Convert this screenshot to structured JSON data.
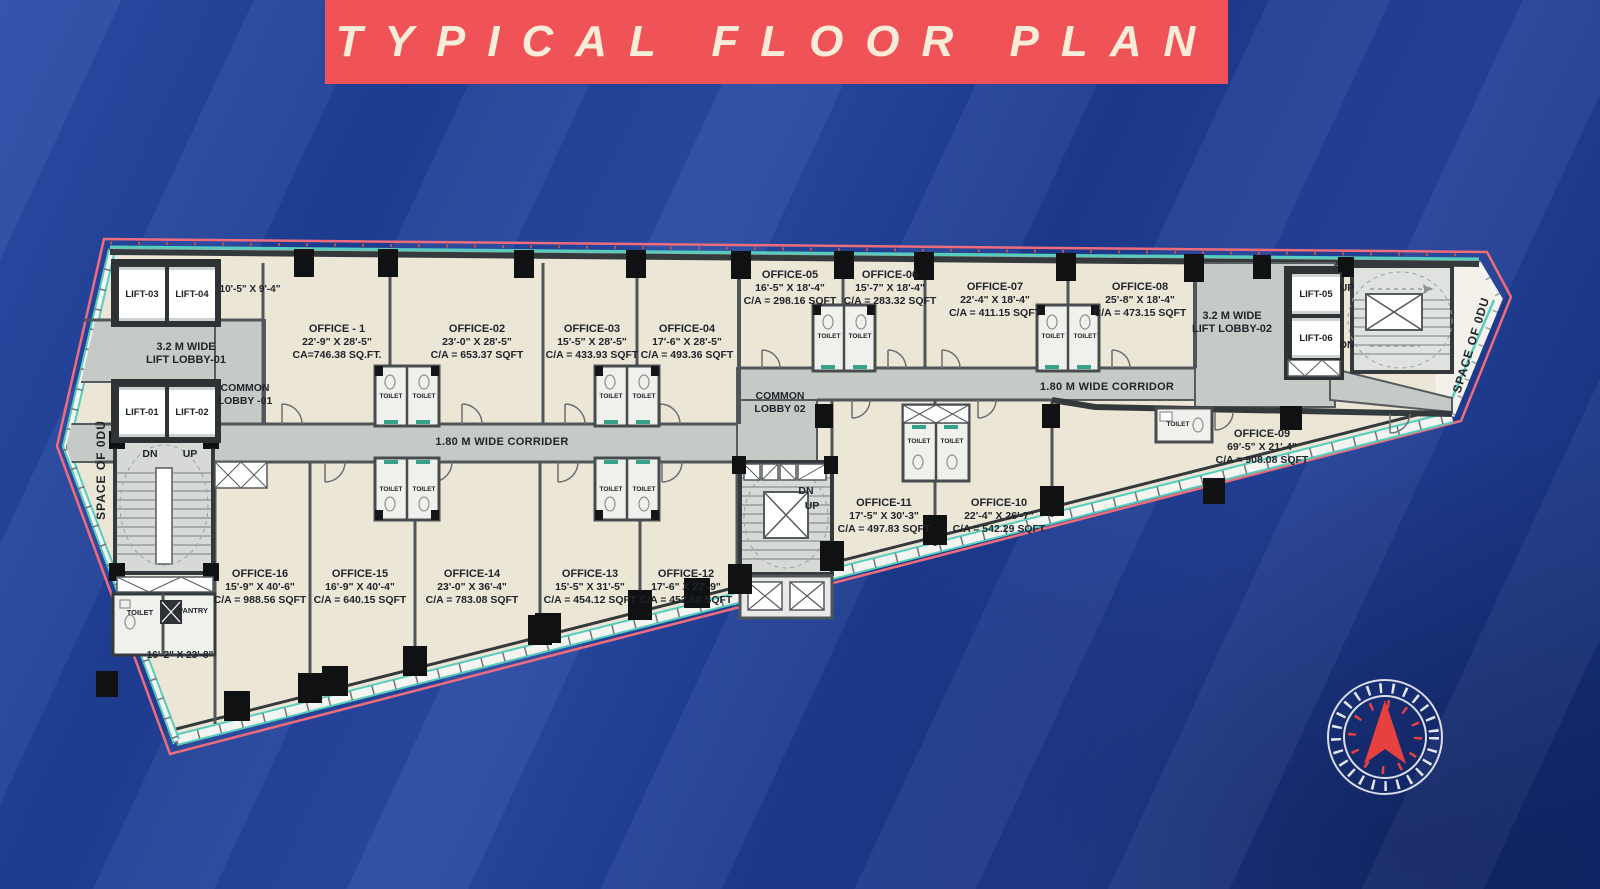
{
  "title": "TYPICAL FLOOR PLAN",
  "colors": {
    "background": "#1d3c90",
    "banner": "#ef5257",
    "banner_text": "#f8ecd8",
    "plan_fill": "#ece6d7",
    "corridor_fill": "#c6cac7",
    "wall": "#34393c",
    "outline_pink": "#ef6c7c",
    "accent_teal": "#57cdbd",
    "column_black": "#101112",
    "compass_arrow": "#e8403f"
  },
  "offices": [
    {
      "name": "OFFICE - 1",
      "dims": "22'-9\" X 28'-5\"",
      "area": "CA=746.38 SQ.FT."
    },
    {
      "name": "OFFICE-02",
      "dims": "23'-0\" X 28'-5\"",
      "area": "C/A = 653.37 SQFT"
    },
    {
      "name": "OFFICE-03",
      "dims": "15'-5\" X 28'-5\"",
      "area": "C/A = 433.93 SQFT"
    },
    {
      "name": "OFFICE-04",
      "dims": "17'-6\" X 28'-5\"",
      "area": "C/A = 493.36 SQFT"
    },
    {
      "name": "OFFICE-05",
      "dims": "16'-5\" X 18'-4\"",
      "area": "C/A = 298.16 SQFT"
    },
    {
      "name": "OFFICE-06",
      "dims": "15'-7\" X 18'-4\"",
      "area": "C/A = 283.32 SQFT"
    },
    {
      "name": "OFFICE-07",
      "dims": "22'-4\" X 18'-4\"",
      "area": "C/A = 411.15 SQFT"
    },
    {
      "name": "OFFICE-08",
      "dims": "25'-8\" X 18'-4\"",
      "area": "C/A = 473.15 SQFT"
    },
    {
      "name": "OFFICE-09",
      "dims": "69'-5\" X 21'-4\"",
      "area": "C/A = 908.08 SQFT"
    },
    {
      "name": "OFFICE-10",
      "dims": "22'-4\" X 26'-7\"",
      "area": "C/A = 542.29 SQFT"
    },
    {
      "name": "OFFICE-11",
      "dims": "17'-5\" X 30'-3\"",
      "area": "C/A = 497.83 SQFT"
    },
    {
      "name": "OFFICE-12",
      "dims": "17'-6\" X 27'-9\"",
      "area": "C/A = 452.60 SQFT"
    },
    {
      "name": "OFFICE-13",
      "dims": "15'-5\" X 31'-5\"",
      "area": "C/A = 454.12 SQFT"
    },
    {
      "name": "OFFICE-14",
      "dims": "23'-0\" X 36'-4\"",
      "area": "C/A = 783.08 SQFT"
    },
    {
      "name": "OFFICE-15",
      "dims": "16'-9\" X 40'-4\"",
      "area": "C/A = 640.15 SQFT"
    },
    {
      "name": "OFFICE-16",
      "dims": "15'-9\" X 40'-6\"",
      "area": "C/A = 988.56 SQFT"
    }
  ],
  "lifts": [
    "LIFT-01",
    "LIFT-02",
    "LIFT-03",
    "LIFT-04",
    "LIFT-05",
    "LIFT-06"
  ],
  "lobbies": {
    "lift_lobby_01": [
      "3.2 M WIDE",
      "LIFT LOBBY-01"
    ],
    "lift_lobby_02": [
      "3.2 M WIDE",
      "LIFT LOBBY-02"
    ],
    "common_lobby_01": [
      "COMMON",
      "LOBBY -01"
    ],
    "common_lobby_02": [
      "COMMON",
      "LOBBY 02"
    ]
  },
  "corridors": {
    "left": "1.80 M WIDE CORRIDER",
    "right": "1.80 M WIDE CORRIDOR"
  },
  "stairs": {
    "up": "UP",
    "dn": "DN"
  },
  "rooms": {
    "toilet": "TOILET",
    "pantry": "PANTRY"
  },
  "dimensions": {
    "lift_block": "10'-5\" X 9'-4\"",
    "bottom_left": "16'-2\" X 23'-8\""
  },
  "space_labels": {
    "left": "SPACE OF 0DU",
    "right": "SPACE OF 0DU"
  }
}
